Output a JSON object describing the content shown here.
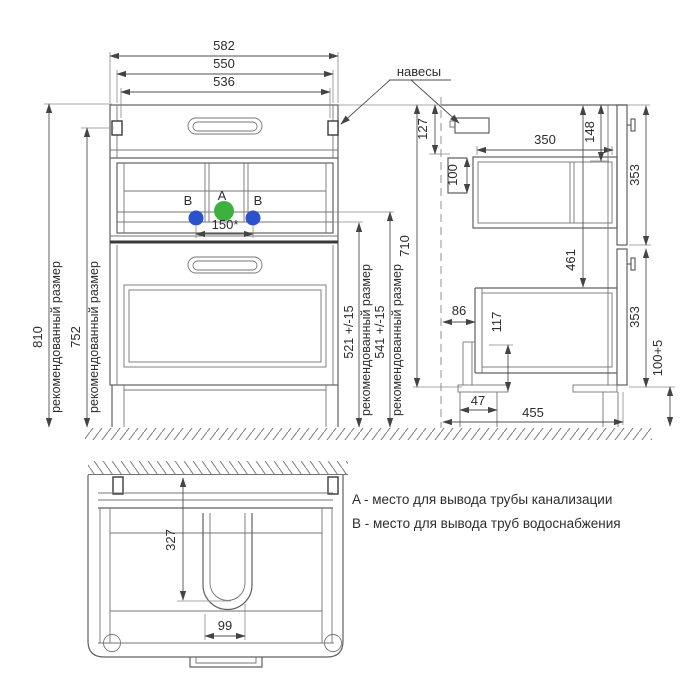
{
  "colors": {
    "pipe_a_green": "#3cb13c",
    "pipe_b_blue": "#2a52cc"
  },
  "front_view": {
    "width_total": "582",
    "width_inner": "550",
    "width_hinges": "536",
    "height_total": "810",
    "height_mount": "752",
    "rec_label": "рекомендованный размер",
    "marker_a": "A",
    "marker_b": "B",
    "spacing_b": "150*",
    "height_pipe_b": "521 +/-15",
    "height_pipe_a": "541 +/-15"
  },
  "side_view": {
    "hinges_label": "навесы",
    "top_to_mount": "127",
    "mount_height": "100",
    "drawer_depth": "350",
    "top_to_drawer": "148",
    "front_panel_top": "353",
    "body_height": "710",
    "top_to_lower_box": "461",
    "wall_gap": "86",
    "leg_height": "117",
    "leg_offset": "47",
    "depth_total": "455",
    "front_panel_bottom": "353",
    "plinth_height": "100+5"
  },
  "bottom_view": {
    "cutout_depth": "327",
    "cutout_width": "99"
  },
  "legend": {
    "line_a": "A - место для вывода трубы канализации",
    "line_b": "B - место для вывода труб водоснабжения"
  }
}
